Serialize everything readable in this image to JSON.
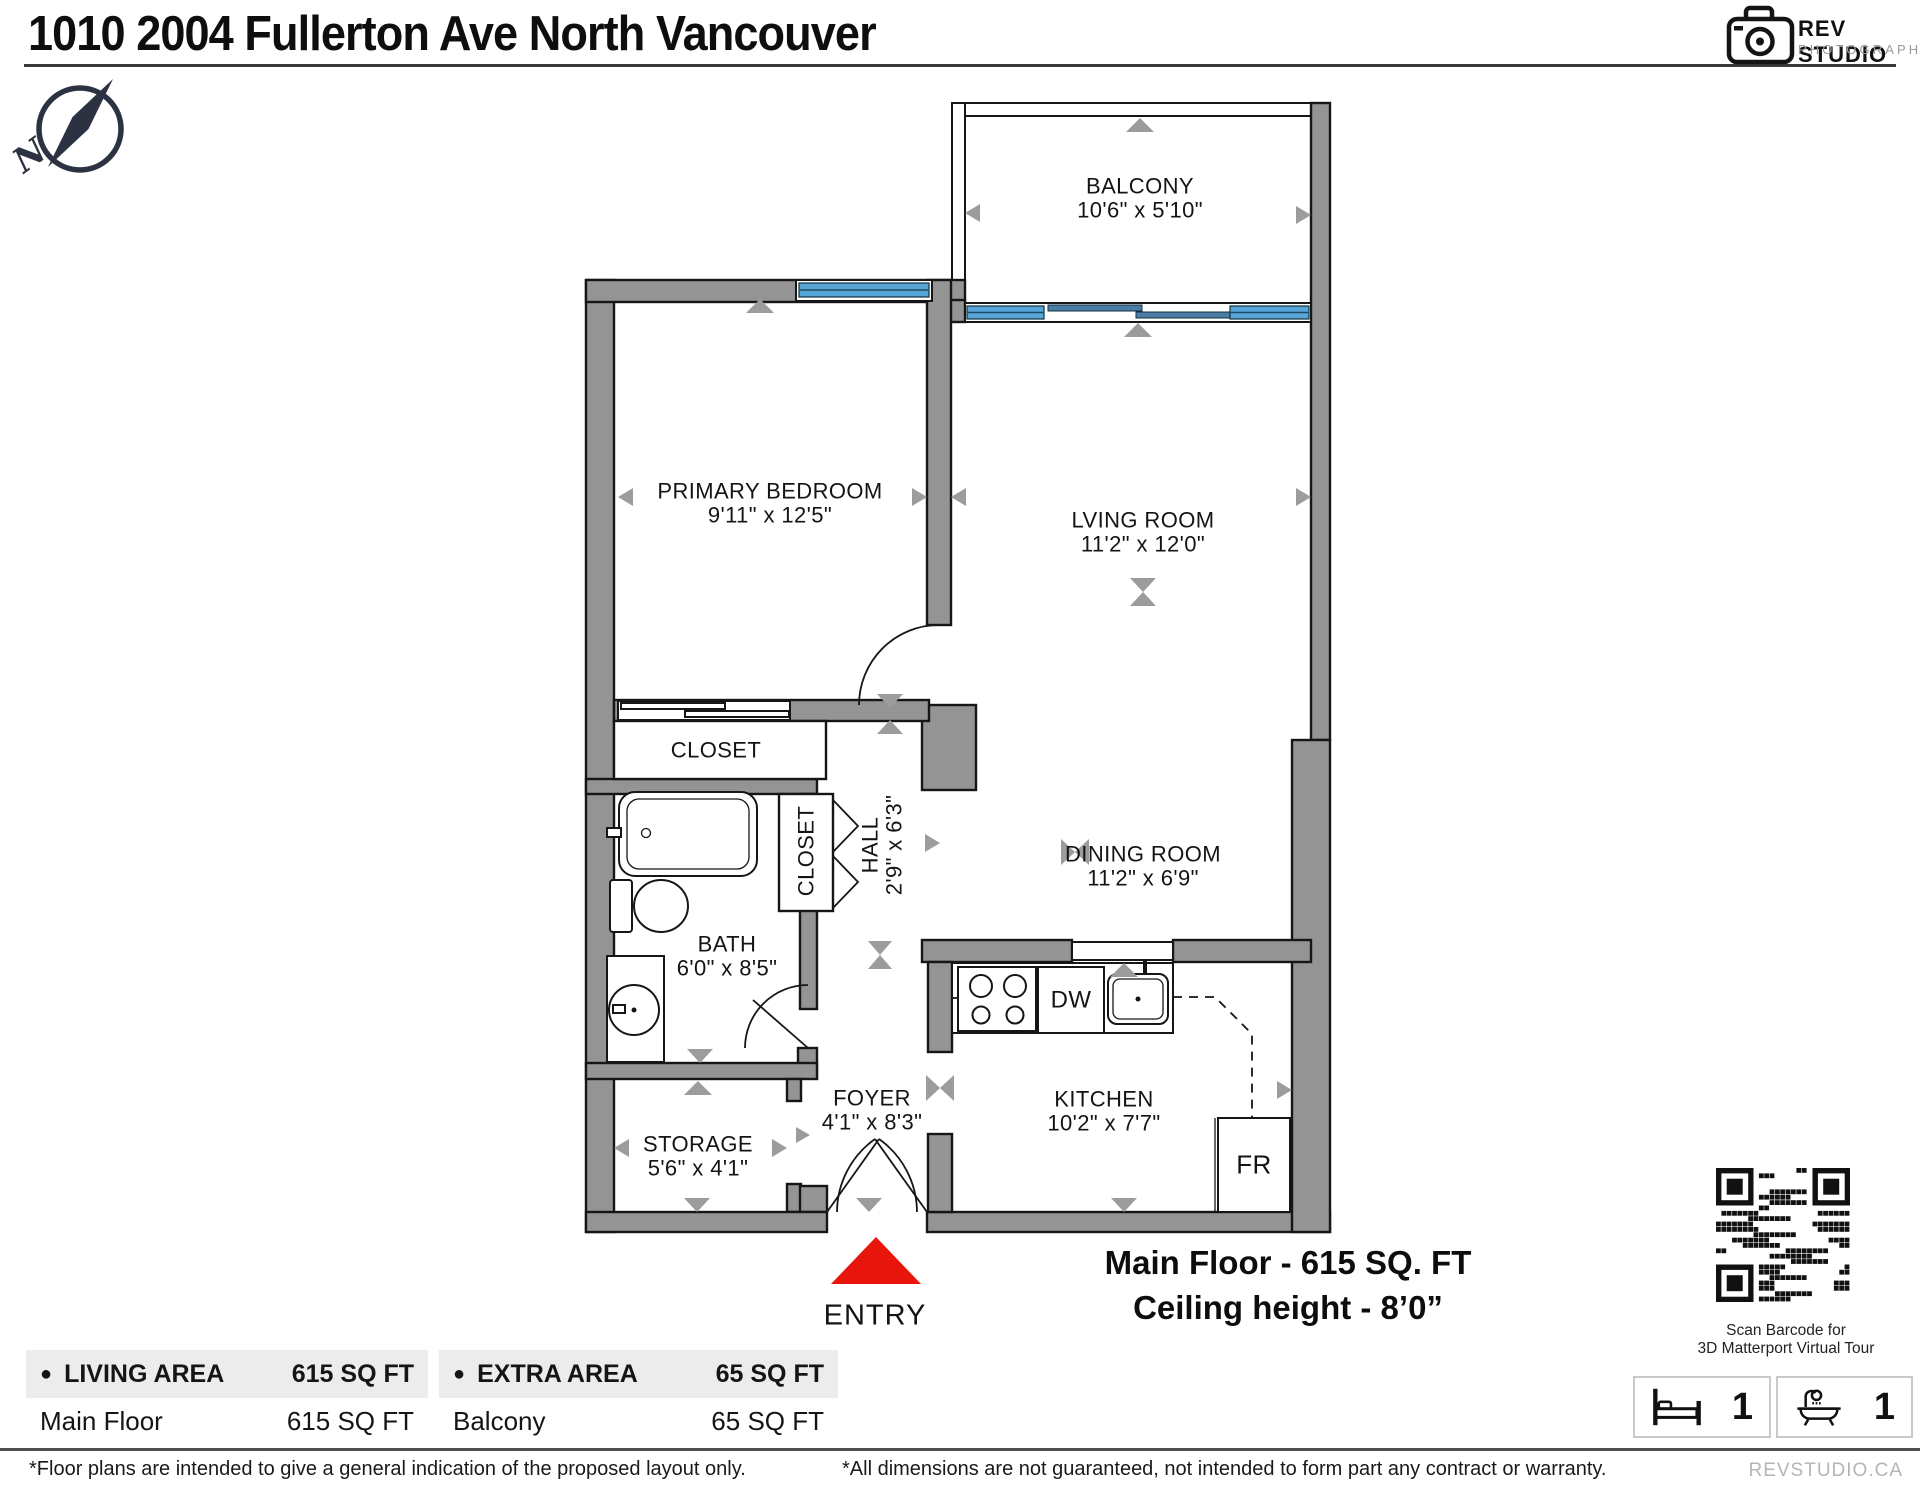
{
  "header": {
    "title": "1010 2004 Fullerton Ave North Vancouver",
    "logo": {
      "name": "REV STUDIO",
      "subtitle": "PHOTOGRAPHY"
    }
  },
  "compass": {
    "north_label": "N"
  },
  "floor_plan": {
    "rooms": [
      {
        "id": "balcony",
        "name": "BALCONY",
        "dims": "10'6\" x 5'10\""
      },
      {
        "id": "primary-bedroom",
        "name": "PRIMARY BEDROOM",
        "dims": "9'11\" x 12'5\""
      },
      {
        "id": "living-room",
        "name": "LVING ROOM",
        "dims": "11'2\" x 12'0\""
      },
      {
        "id": "dining-room",
        "name": "DINING ROOM",
        "dims": "11'2\" x 6'9\""
      },
      {
        "id": "bedroom-closet",
        "name": "CLOSET",
        "dims": ""
      },
      {
        "id": "hall-closet",
        "name": "CLOSET",
        "dims": ""
      },
      {
        "id": "hall",
        "name": "HALL",
        "dims": "2'9\" x 6'3\""
      },
      {
        "id": "bath",
        "name": "BATH",
        "dims": "6'0\" x 8'5\""
      },
      {
        "id": "storage",
        "name": "STORAGE",
        "dims": "5'6\" x 4'1\""
      },
      {
        "id": "foyer",
        "name": "FOYER",
        "dims": "4'1\" x 8'3\""
      },
      {
        "id": "kitchen",
        "name": "KITCHEN",
        "dims": "10'2\" x 7'7\""
      }
    ],
    "appliances": {
      "dishwasher": "DW",
      "fridge": "FR"
    },
    "entry_label": "ENTRY",
    "colors": {
      "wall": "#949494",
      "window": "#58a6d8",
      "marker": "#9c9c9c",
      "entry": "#e8150d"
    }
  },
  "summary": {
    "line1": "Main Floor - 615 SQ. FT",
    "line2": "Ceiling height - 8’0”"
  },
  "qr": {
    "caption_line1": "Scan Barcode for",
    "caption_line2": "3D Matterport Virtual Tour"
  },
  "stats": {
    "bedrooms": "1",
    "bathrooms": "1"
  },
  "legend": {
    "living": {
      "header": "LIVING AREA",
      "header_value": "615 SQ FT",
      "row_label": "Main Floor",
      "row_value": "615 SQ FT"
    },
    "extra": {
      "header": "EXTRA AREA",
      "header_value": "65 SQ FT",
      "row_label": "Balcony",
      "row_value": "65 SQ FT"
    }
  },
  "footer": {
    "left": "*Floor plans are intended to give a general indication of the proposed layout only.",
    "center": "*All dimensions are not guaranteed, not intended to form part any contract or warranty.",
    "brand": "REVSTUDIO.CA"
  }
}
